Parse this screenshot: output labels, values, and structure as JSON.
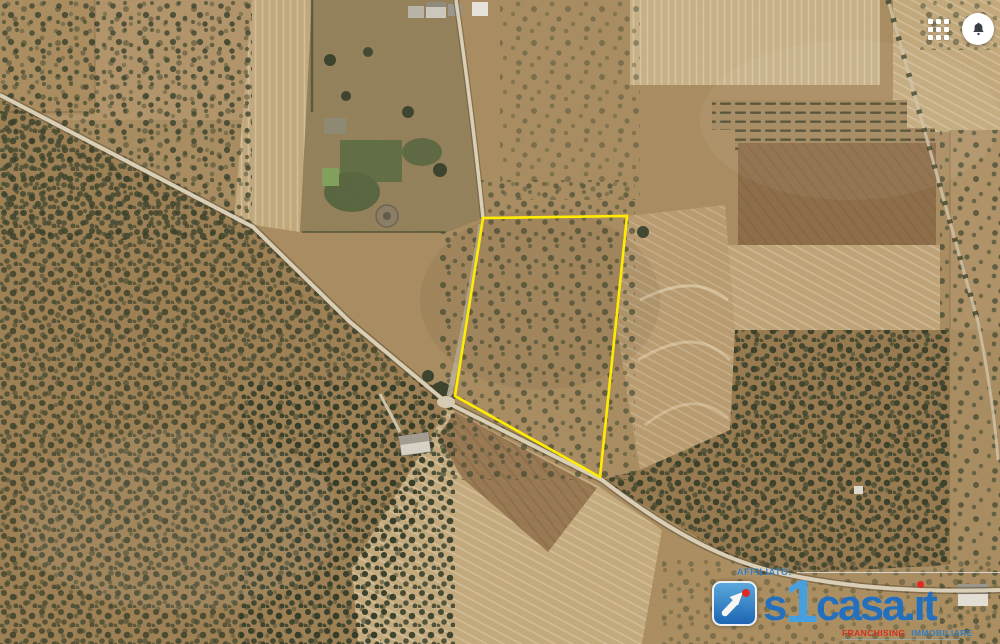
{
  "window": {
    "width": 1000,
    "height": 644,
    "view": "satellite-aerial-imagery"
  },
  "hud": {
    "apps_grid_icon": "apps-grid",
    "notifications_icon": "bell"
  },
  "map": {
    "type": "satellite",
    "scene": "rural olive-grove farmland with dirt roads and plowed parcels",
    "features": {
      "highlight": {
        "label": "property-boundary",
        "points": "483,218 627,216 600,477 455,396",
        "stroke_color": "#ffec00"
      }
    }
  },
  "watermark": {
    "affiliate_label": "AFFILIATO:",
    "brand_full": "s1casa.it",
    "brand": {
      "prefix": "s",
      "one": "1",
      "middle": "casa",
      "dot": ".",
      "i": "ı",
      "t": "t"
    },
    "tagline": {
      "left": "FRANCHISING",
      "right": "IMMOBILIARE"
    },
    "colors": {
      "blue": "#1b6ec4",
      "light_blue": "#3fa2e9",
      "red": "#e42320",
      "label_blue": "#2e7cc3",
      "highlight_yellow": "#ffec00"
    }
  }
}
